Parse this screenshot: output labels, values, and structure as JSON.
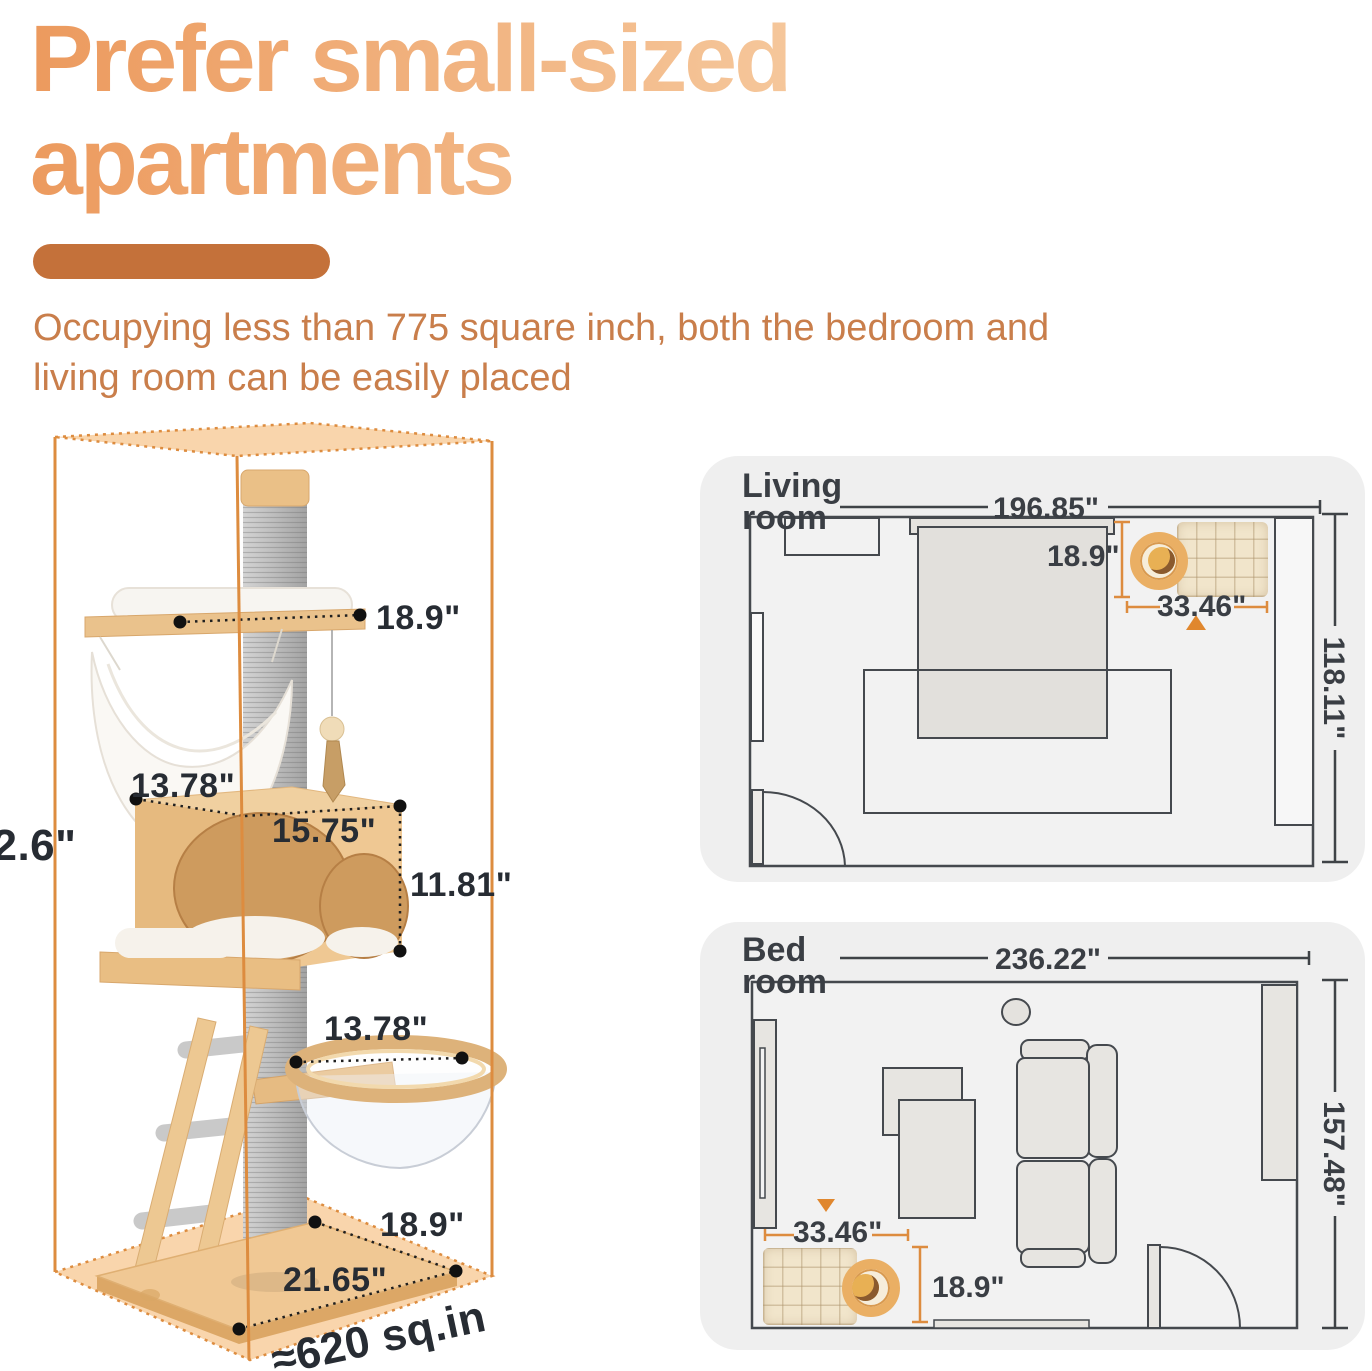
{
  "header": {
    "title_line1": "Prefer small-sized",
    "title_line2": "apartments",
    "subtitle_line1": "Occupying less than 775 square inch, both the bedroom and",
    "subtitle_line2": "living room can be easily placed"
  },
  "colors": {
    "title_gradient_start": "#EC9A5E",
    "title_gradient_end": "#F9D8B2",
    "divider": "#C4713A",
    "subtitle_text": "#C97E4B",
    "bounding_box_orange": "#DD8C3F",
    "bounding_box_fill": "#F8D0A3",
    "dimension_text": "#272C33",
    "plan_line": "#45494E",
    "plan_accent_orange": "#DD8C3F",
    "panel_background": "#EFEFEF",
    "wood": "#EFC894",
    "sisal_gray": "#BDBDBD"
  },
  "cat_tree": {
    "total_height": "62.6\"",
    "top_platform_width": "18.9\"",
    "condo_depth": "13.78\"",
    "condo_width": "15.75\"",
    "condo_height": "11.81\"",
    "bowl_diameter": "13.78\"",
    "base_depth": "18.9\"",
    "base_width": "21.65\"",
    "footprint": "≈620 sq.in"
  },
  "living_room": {
    "title_line1": "Living",
    "title_line2": "room",
    "room_width": "196.85\"",
    "room_depth": "118.11\"",
    "tree_width": "33.46\"",
    "tree_depth": "18.9\""
  },
  "bedroom": {
    "title_line1": "Bed",
    "title_line2": "room",
    "room_width": "236.22\"",
    "room_depth": "157.48\"",
    "tree_width": "33.46\"",
    "tree_depth": "18.9\""
  }
}
